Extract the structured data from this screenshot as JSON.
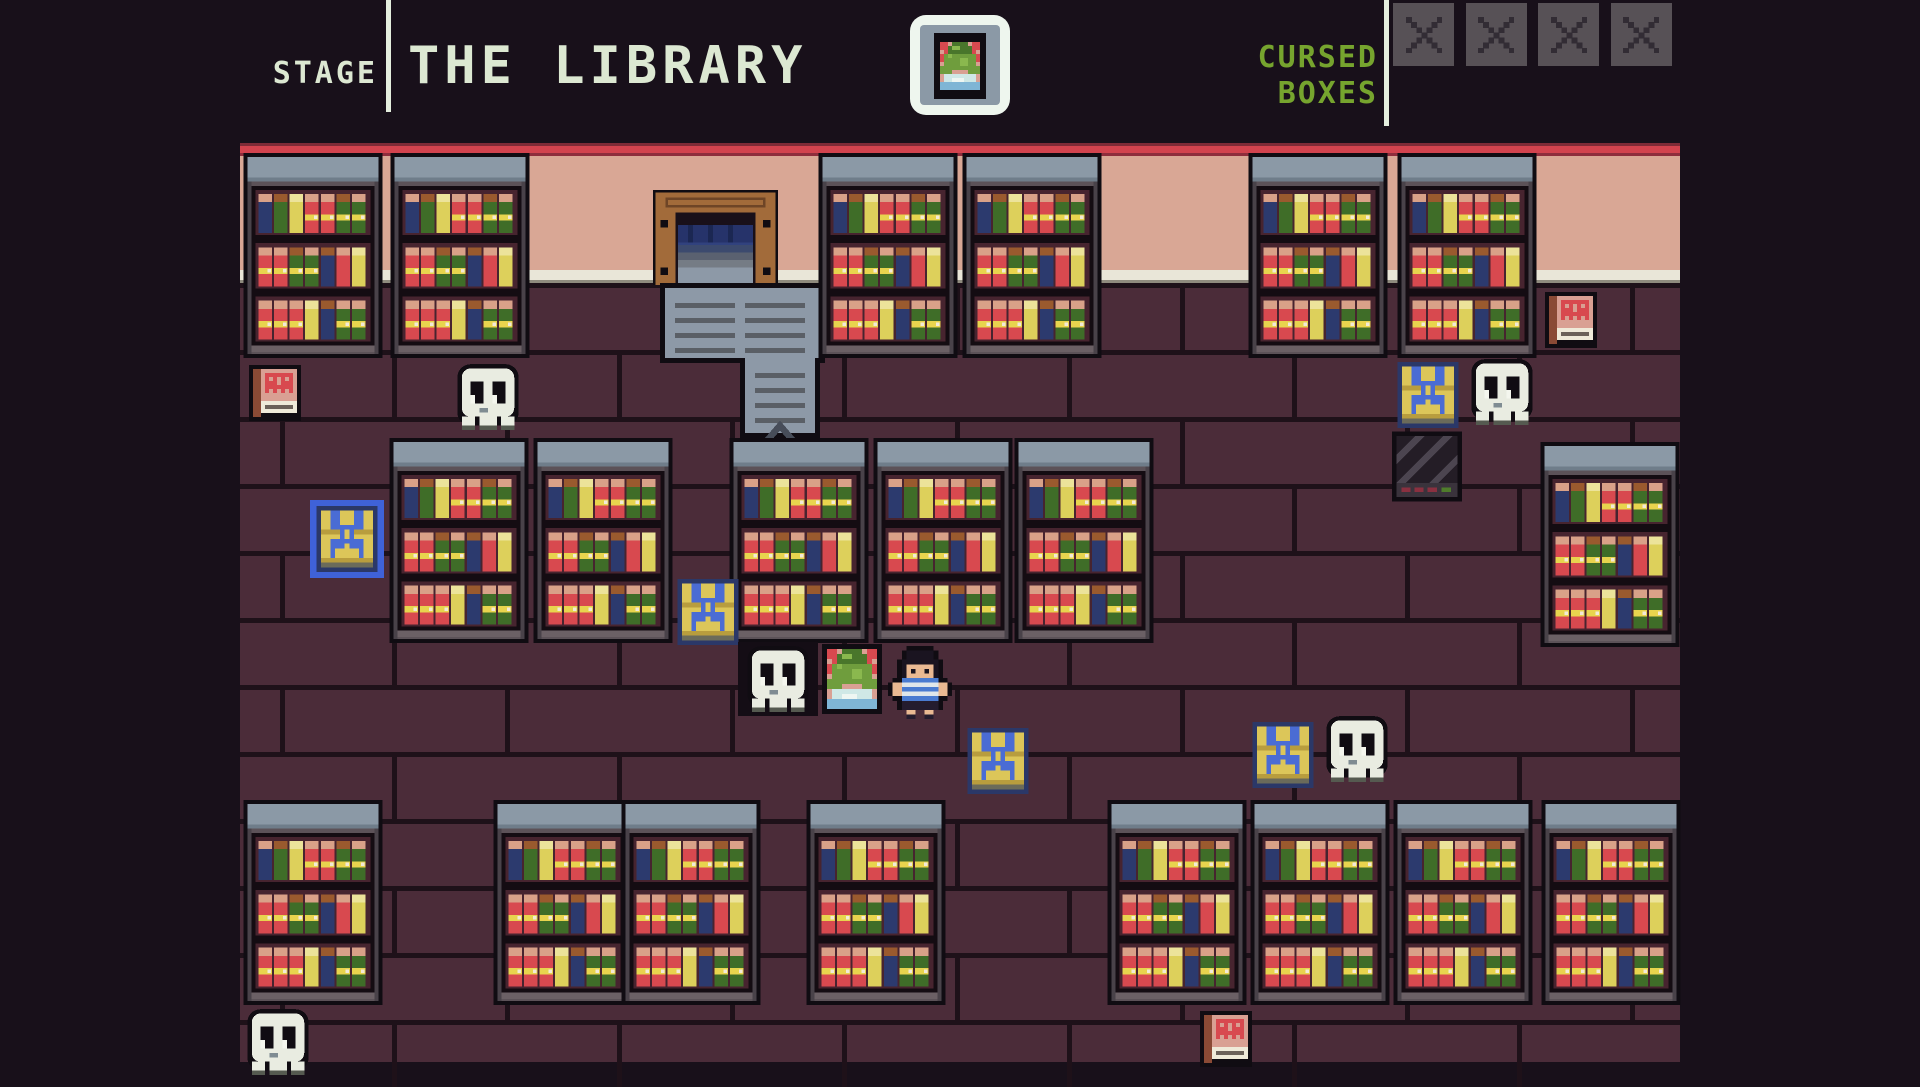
{
  "header": {
    "stage_label": "STAGE",
    "stage_name": "THE LIBRARY",
    "objective_line1": "CURSED",
    "objective_line2": "BOXES",
    "objective_slots": [
      "x",
      "x",
      "x",
      "x"
    ]
  },
  "colors": {
    "background": "#18101a",
    "header_text": "#dce8d2",
    "objective_green": "#76a42e",
    "slot_gray": "#575156",
    "slot_mark": "#322c34",
    "divider": "#e4eede",
    "red_strip": "#d2434e",
    "wall": "#d9a795",
    "baseboard": "#e9e6d8",
    "floor": "#4b2c39",
    "mortar": "#1e1119",
    "outline": "#100c12",
    "shelf_top": "#8b99a6",
    "shelf_body": "#5c5258",
    "shelf_recess": "#47242f",
    "shelf_board": "#6b6065",
    "book_red": "#d8494f",
    "book_green": "#3f6d28",
    "book_blue": "#2c3a6e",
    "book_yellow": "#ddd05b",
    "book_top_tan": "#d9a188",
    "book_top_brown": "#9a5a2e",
    "book_band": "#e8d44e",
    "door_frame": "#a26b3a",
    "door_frame_dark": "#6e4526",
    "door_interior": "#191019",
    "curtain": "#26336a",
    "curtain_dark": "#1b2752",
    "stairs": "#8d99a7",
    "stairs_line": "#5a5f66",
    "arrow": "#474d59",
    "ghost_body": "#e9ece1",
    "ghost_pupil": "#f4f6ee",
    "ghost_shadow": "#555a50",
    "chest_yellow": "#dcc659",
    "chest_yellow_dark": "#b89d3e",
    "chest_blue": "#4a6cd4",
    "chest_navy": "#2b3868",
    "chest_base": "#6b6b5a",
    "chest_highlight": "#3f62d8",
    "cursed_body": "#241d26",
    "cursed_stripe": "#4c4550",
    "cursed_panel": "#3a333c",
    "cursed_dash_red": "#8a3040",
    "cursed_dash_green": "#4f7c2b",
    "spellbook_cover": "#d9a093",
    "spellbook_face": "#d8494f",
    "spellbook_spine": "#8a4a35",
    "spellbook_pages": "#efead9",
    "player_shirt": "#4a7bd0",
    "player_skin": "#eab992",
    "frog_green": "#6f9d3d",
    "frog_dark_green": "#49762b",
    "water_blue": "#7fb5d5"
  },
  "scene": {
    "shelves_top_y": 10,
    "shelves_mid_y": 295,
    "shelves_bottom_y": 657,
    "shelves_top_x": [
      3,
      150,
      578,
      722,
      1008,
      1157
    ],
    "shelves_mid": [
      [
        149,
        295
      ],
      [
        293,
        295
      ],
      [
        489,
        295
      ],
      [
        633,
        295
      ],
      [
        774,
        295
      ],
      [
        1300,
        299
      ]
    ],
    "shelves_bottom_x": [
      3,
      253,
      381,
      566,
      867,
      1010,
      1153,
      1301
    ],
    "door": {
      "x": 413,
      "y": 47
    },
    "stairs": {
      "x": 420,
      "y": 140
    },
    "ghosts": [
      {
        "x": 213,
        "y": 221,
        "dark_bg": false
      },
      {
        "x": 503,
        "y": 503,
        "dark_bg": true
      },
      {
        "x": 1227,
        "y": 216,
        "dark_bg": false
      },
      {
        "x": 1082,
        "y": 573,
        "dark_bg": false
      },
      {
        "x": 3,
        "y": 866,
        "dark_bg": false
      }
    ],
    "chests": [
      {
        "x": 76,
        "y": 363,
        "highlighted": true
      },
      {
        "x": 437,
        "y": 436,
        "highlighted": false
      },
      {
        "x": 727,
        "y": 585,
        "highlighted": false
      },
      {
        "x": 1012,
        "y": 579,
        "highlighted": false
      },
      {
        "x": 1157,
        "y": 219,
        "highlighted": false
      }
    ],
    "spellbooks": [
      {
        "x": 9,
        "y": 221
      },
      {
        "x": 1305,
        "y": 148
      },
      {
        "x": 960,
        "y": 867
      }
    ],
    "cursed_box": {
      "x": 1152,
      "y": 287
    },
    "frog_portrait": {
      "x": 582,
      "y": 501
    },
    "player": {
      "x": 648,
      "y": 503
    }
  }
}
